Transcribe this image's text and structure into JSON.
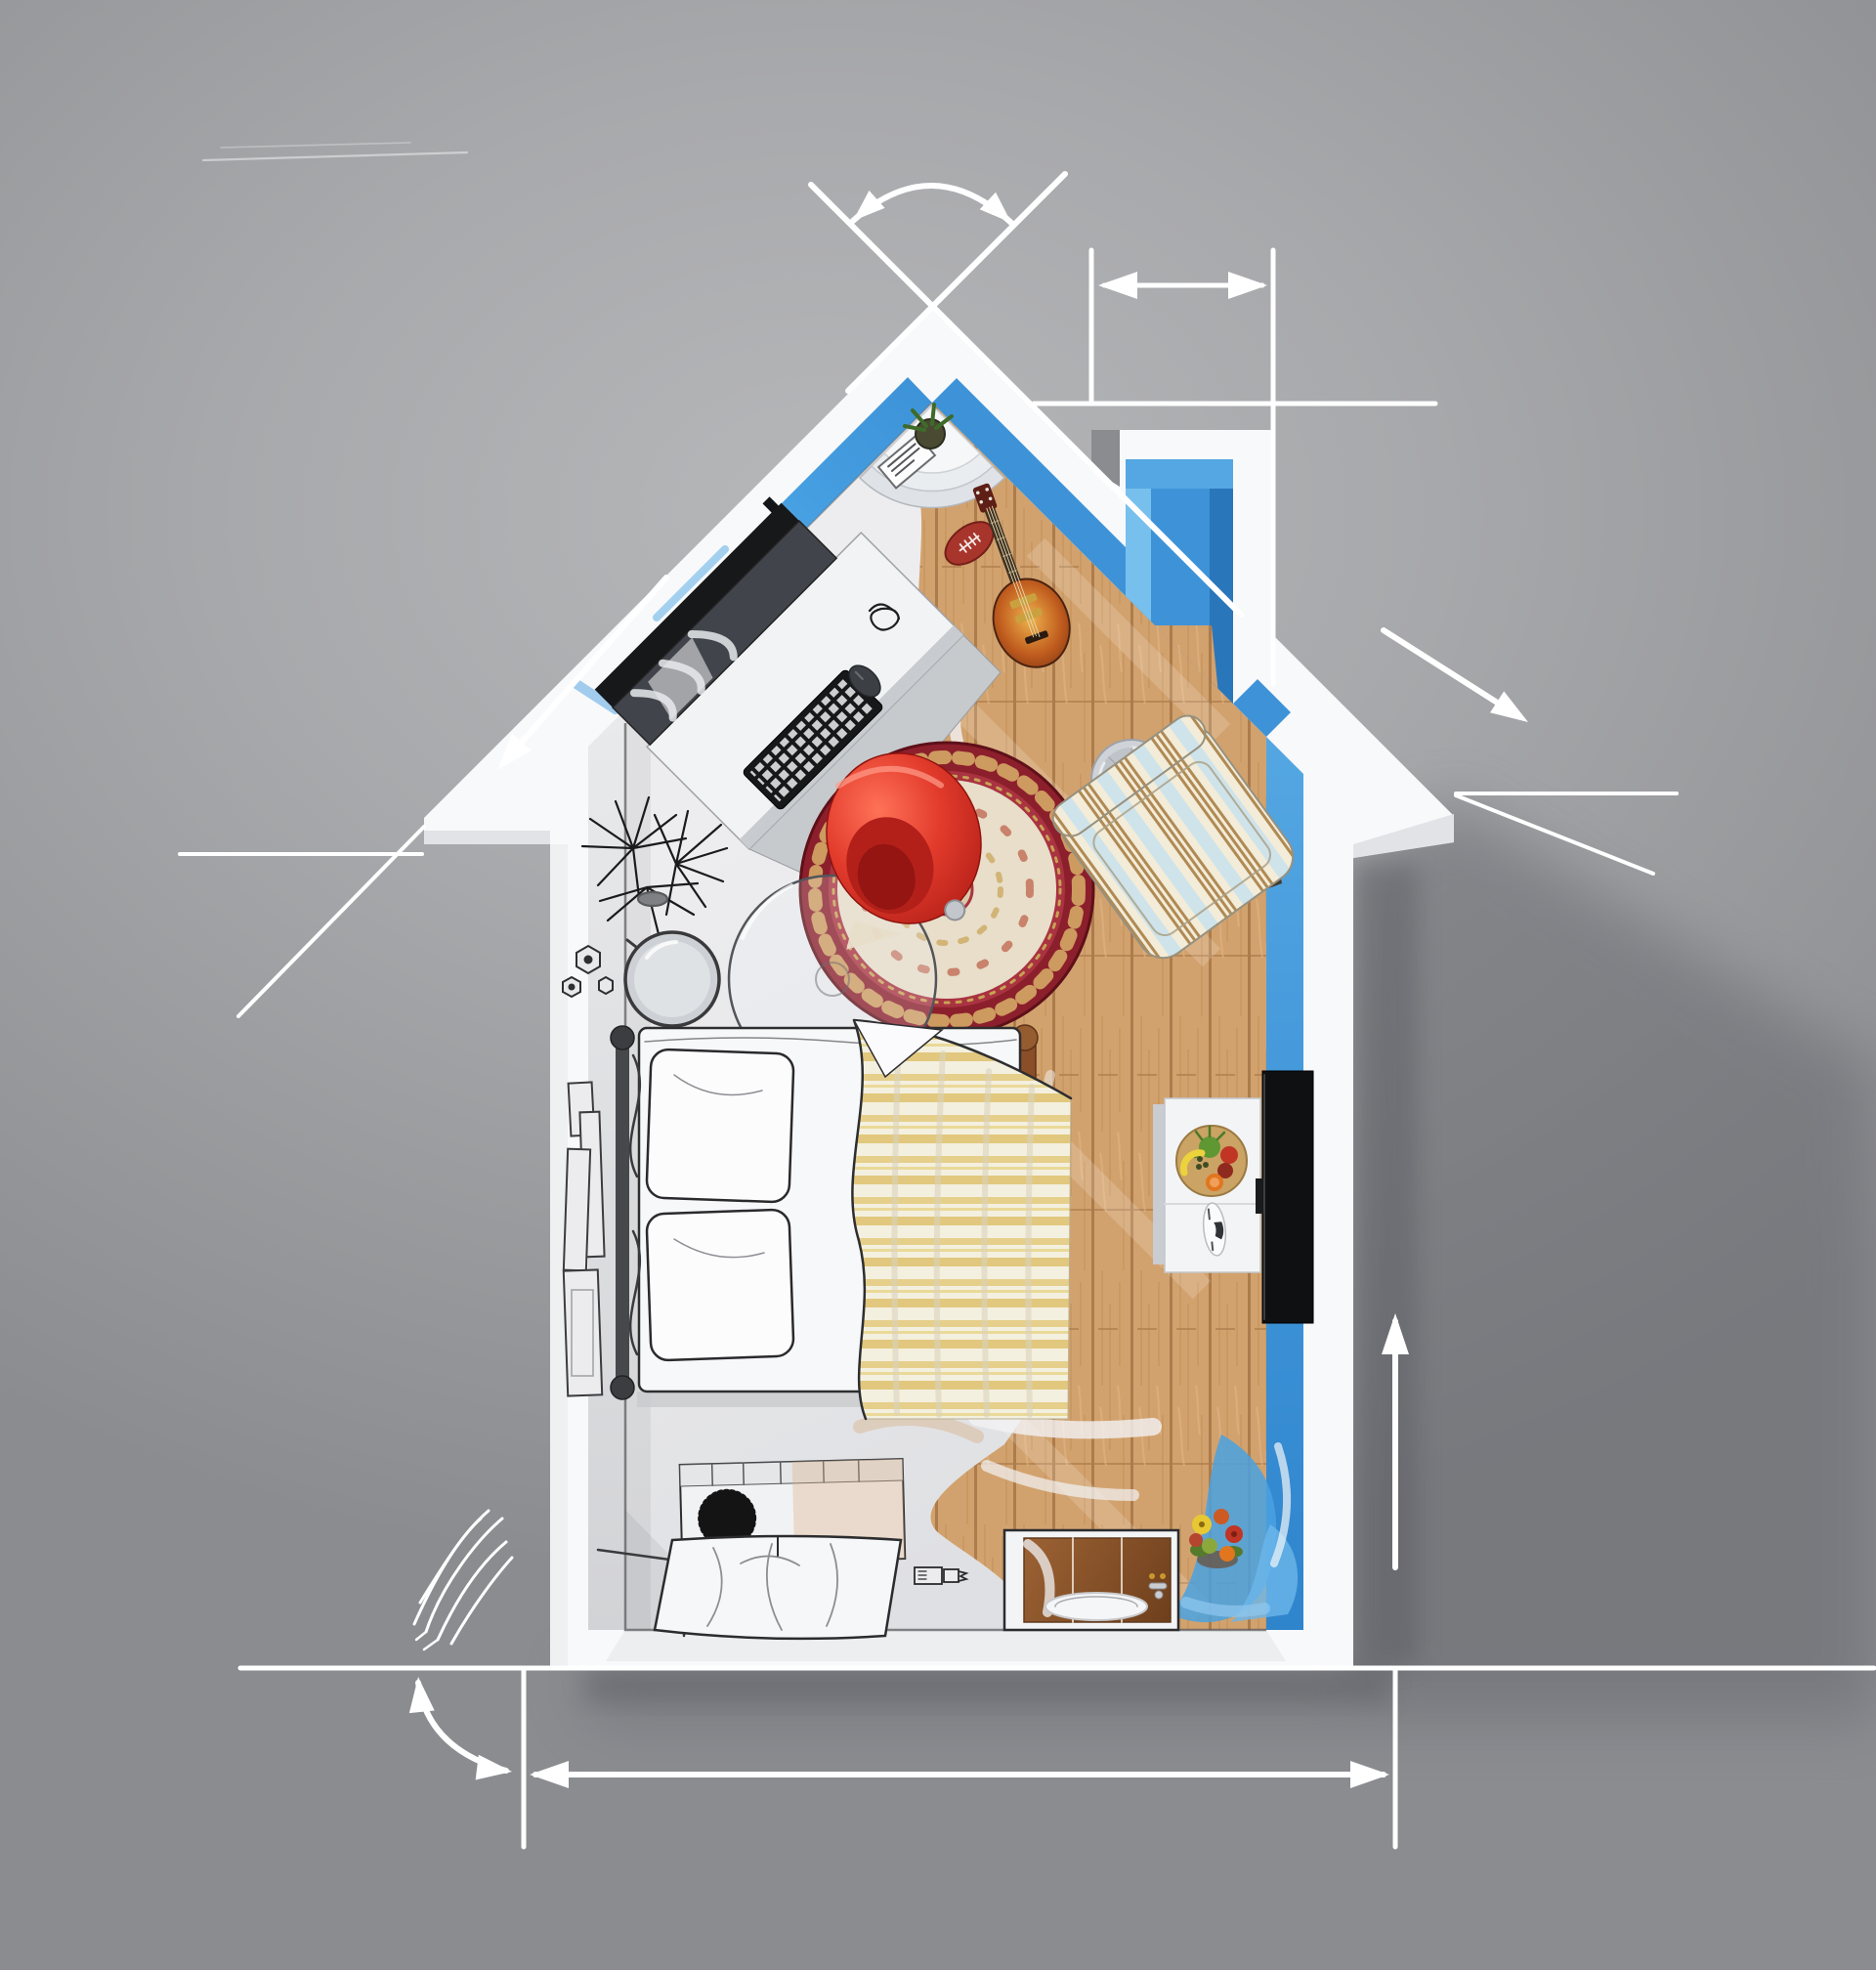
{
  "scene": {
    "type": "3d-architectural-illustration",
    "subject": "house-shaped miniature room, top view, half blueprint sketch / half color render",
    "room": "studio bedroom",
    "no_visible_text": true
  },
  "colors": {
    "background_light": "#b6b7b9",
    "background_dark": "#8b8c90",
    "cast_shadow": "#64656a",
    "house_white": "#f8f9fb",
    "wall_blue": "#3e93d8",
    "wall_blue_light": "#77c0ee",
    "wall_blue_mid": "#54a7e2",
    "wall_blue_dark": "#2a76ba",
    "wall_gray_face": "#dcdde0",
    "floor_sketch": "#ededef",
    "floor_sketch_shade": "#d6d7da",
    "wood_base": "#d2a26e",
    "wood_seam": "#ad7c4c",
    "wood_grain": "#c5925c",
    "wood_light": "#e0b685",
    "annotation_white": "#ffffff",
    "sketch_line": "#2e2e30",
    "rug_border": "#8c1f2c",
    "rug_border_inner": "#a93340",
    "rug_field": "#e8dec9",
    "rug_gold": "#d8b069",
    "chair_red": "#e23b2c",
    "chair_red_dark": "#a81812",
    "blanket_cream": "#f4f0df",
    "blanket_yellow": "#e5cf8b",
    "armchair_cream": "#f3ecd9",
    "armchair_stripe_brown": "#b08a54",
    "armchair_stripe_blue": "#cfe3ea",
    "tv_black": "#0f1012",
    "console_white": "#f3f4f6",
    "bed_frame_iron": "#47484c",
    "bed_rail_wood": "#8a4f28",
    "sink_wood": "#8a5427",
    "metal_gray": "#cfd3d8",
    "monitor_dark": "#17181a",
    "screen_gray": "#41454b",
    "keyboard_black": "#17181a",
    "plant_black": "#1b1b1d",
    "guitar_light": "#eeb24c",
    "guitar_mid": "#c05c1e",
    "guitar_dark": "#6e2a10",
    "fruit_green": "#5f9733",
    "fruit_red": "#c03524",
    "fruit_orange": "#e2761f",
    "fruit_yellow": "#ecd23c",
    "bowl_tan": "#caa365",
    "flower_yellow": "#e8c832"
  },
  "house": {
    "outer_walls": "thick white silhouette with gabled roof and chimney notch on right roof slope",
    "inner_wall_finish_left": "unfinished sketch gray",
    "inner_wall_finish_right": "painted blue",
    "floor_finish_left": "unfinished white sketch",
    "floor_finish_right": "wood planks",
    "paint_transition": "painterly brushed edge from sketch to color"
  },
  "furniture": [
    {
      "name": "corner-shelf",
      "desc": "white quarter-fan shelves in apex corner with vase and photo frame"
    },
    {
      "name": "desk",
      "desc": "white desk along left roof wall"
    },
    {
      "name": "monitor",
      "desc": "widescreen monitor with sketched drape on screen"
    },
    {
      "name": "keyboard",
      "desc": "black keyboard"
    },
    {
      "name": "mouse",
      "desc": "black mouse"
    },
    {
      "name": "cable-tangle",
      "desc": "sketched cable scribble"
    },
    {
      "name": "football",
      "desc": "american football on wood floor"
    },
    {
      "name": "electric-guitar",
      "desc": "sunburst electric guitar"
    },
    {
      "name": "desk-fan",
      "desc": "chrome desk fan"
    },
    {
      "name": "round-rug",
      "desc": "round oriental rug, red border, cream field"
    },
    {
      "name": "red-chair",
      "desc": "glossy red shell chair"
    },
    {
      "name": "glass-table",
      "desc": "round glass table, sketch outline"
    },
    {
      "name": "striped-armchair",
      "desc": "striped upholstered armchair"
    },
    {
      "name": "potted-plant",
      "desc": "sketched black spiky plant"
    },
    {
      "name": "mirror",
      "desc": "round standing mirror, sketch"
    },
    {
      "name": "perfume-bottles",
      "desc": "small sketched bottles"
    },
    {
      "name": "wall-frames",
      "desc": "picture frames on left wall, sketch"
    },
    {
      "name": "bed",
      "desc": "double bed, iron headboard, wood foot rail"
    },
    {
      "name": "pillows",
      "desc": "two white sketched pillows"
    },
    {
      "name": "blanket",
      "desc": "yellow striped draped blanket"
    },
    {
      "name": "dresser",
      "desc": "low dresser with black pompom decor, sketch"
    },
    {
      "name": "cloth-table",
      "desc": "table draped with white cloth, sketch"
    },
    {
      "name": "sink-vanity",
      "desc": "wood sink vanity, half painted"
    },
    {
      "name": "flower-pot",
      "desc": "colorful flower arrangement"
    },
    {
      "name": "tv",
      "desc": "flat TV on right blue wall"
    },
    {
      "name": "tv-console",
      "desc": "white console with fruit bowl and model car"
    }
  ],
  "annotations": [
    {
      "name": "apex-crossing-lines",
      "type": "construction lines crossing at roof apex"
    },
    {
      "name": "apex-angle-arc",
      "type": "roof pitch angle arc with two arrowheads"
    },
    {
      "name": "chimney-width-dimension",
      "type": "two verticals + double headed arrow"
    },
    {
      "name": "chimney-level-line",
      "type": "horizontal construction line"
    },
    {
      "name": "left-roof-arrow",
      "type": "arrow parallel to left roof slope"
    },
    {
      "name": "right-roof-arrow",
      "type": "arrow parallel to right roof slope"
    },
    {
      "name": "eave-extension-lines",
      "type": "thin lines extending from both eave tips"
    },
    {
      "name": "elevation-arrow",
      "type": "vertical arrow pointing up, right of house"
    },
    {
      "name": "ground-baseline",
      "type": "long horizontal line at house base"
    },
    {
      "name": "width-dimension",
      "type": "dimension line with end ticks and outward arrowheads"
    },
    {
      "name": "corner-angle-arc",
      "type": "quarter arc with arrowheads, bottom left"
    },
    {
      "name": "hatch-scribble",
      "type": "hand-drawn hatch marks"
    },
    {
      "name": "faint-sketch-lines",
      "type": "faint pencil lines, top left"
    }
  ]
}
